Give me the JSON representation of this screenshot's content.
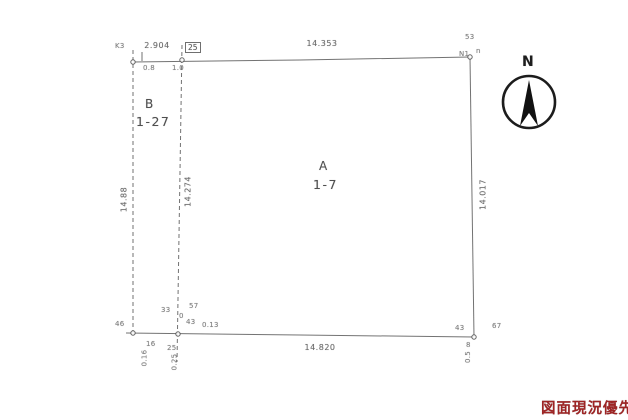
{
  "colors": {
    "ink": "#5a5a5a",
    "stamp_red": "#9e2424"
  },
  "north": {
    "label": "N"
  },
  "parcels": {
    "a": {
      "letter": "A",
      "number": "1-7"
    },
    "b": {
      "letter": "B",
      "number": "1-27"
    }
  },
  "dimensions": {
    "top_b_width": "2.904",
    "top_boxed": "25",
    "top_width": "14.353",
    "bottom_width": "14.820",
    "left_height": "14.88",
    "inner_height": "14.274",
    "right_height": "14.017"
  },
  "annotations": [
    {
      "text": "K3"
    },
    {
      "text": "0.8"
    },
    {
      "text": "1.0"
    },
    {
      "text": "53"
    },
    {
      "text": "N1"
    },
    {
      "text": "n"
    },
    {
      "text": "46"
    },
    {
      "text": "33"
    },
    {
      "text": "0"
    },
    {
      "text": "57"
    },
    {
      "text": "43"
    },
    {
      "text": "0.13"
    },
    {
      "text": "16"
    },
    {
      "text": "25"
    },
    {
      "text": "0.16"
    },
    {
      "text": "0.25"
    },
    {
      "text": "43"
    },
    {
      "text": "67"
    },
    {
      "text": "8"
    },
    {
      "text": "0.5"
    }
  ],
  "stamp": {
    "text": "図面現況優先"
  }
}
